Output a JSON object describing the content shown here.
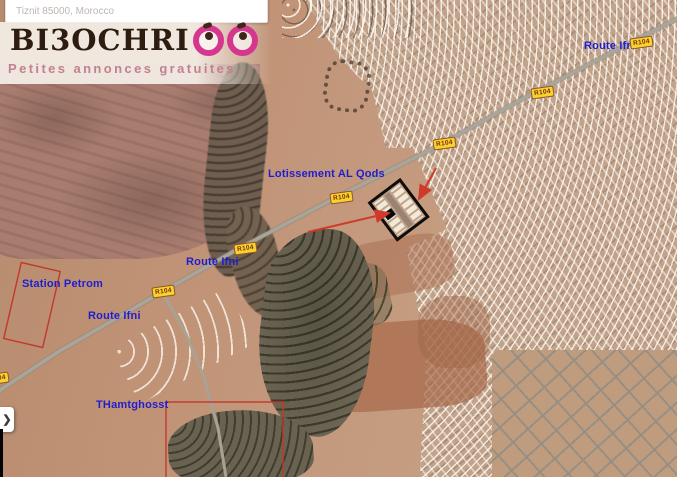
{
  "search": {
    "value": "Tiznit 85000, Morocco"
  },
  "brand": {
    "name": "BI3OCHRI",
    "tagline": "Petites annonces gratuites"
  },
  "map": {
    "labels": [
      {
        "id": "route-ifni-top",
        "text": "Route Ifni"
      },
      {
        "id": "lotissement",
        "text": "Lotissement AL Qods"
      },
      {
        "id": "route-ifni-mid",
        "text": "Route Ifni"
      },
      {
        "id": "station-petrom",
        "text": "Station Petrom"
      },
      {
        "id": "route-ifni-left",
        "text": "Route Ifni"
      },
      {
        "id": "thamtghosst",
        "text": "THamtghosst"
      }
    ],
    "badges": [
      {
        "text": "R104"
      },
      {
        "text": "R104"
      },
      {
        "text": "R104"
      },
      {
        "text": "R104"
      },
      {
        "text": "R104"
      },
      {
        "text": "R104"
      },
      {
        "text": "R104"
      }
    ]
  },
  "controls": {
    "expand_chevron": "❯"
  },
  "colors": {
    "label_blue": "#1e1ecf",
    "badge_yellow": "#f6d32d",
    "annotation_red": "#cf3a2a",
    "brand_pink": "#d6378e",
    "lotissement_outline": "#0d0d0d"
  }
}
